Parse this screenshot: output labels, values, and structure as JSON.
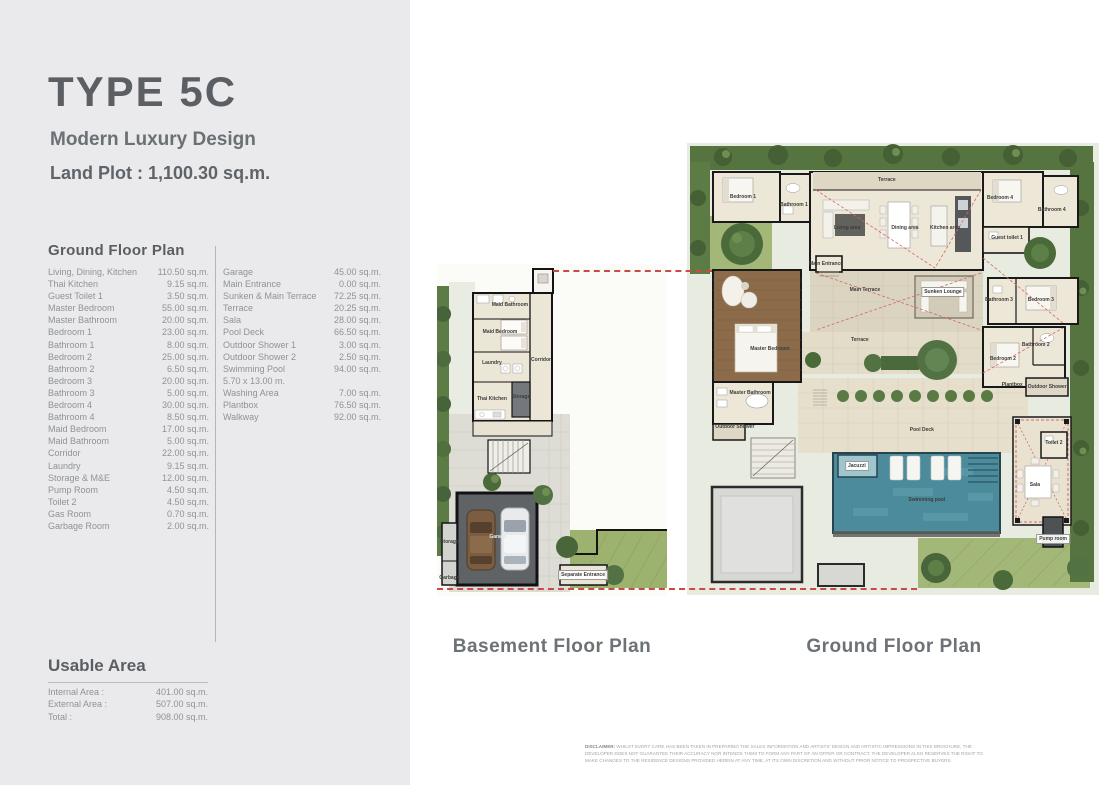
{
  "header": {
    "title": "TYPE 5C",
    "subtitle": "Modern Luxury Design",
    "land_plot": "Land Plot : 1,100.30 sq.m."
  },
  "area_table": {
    "heading": "Ground Floor Plan",
    "col1": [
      {
        "label": "Living, Dining, Kitchen",
        "value": "110.50 sq.m."
      },
      {
        "label": "Thai Kitchen",
        "value": "9.15 sq.m."
      },
      {
        "label": "Guest Toilet 1",
        "value": "3.50 sq.m."
      },
      {
        "label": "Master Bedroom",
        "value": "55.00 sq.m."
      },
      {
        "label": "Master Bathroom",
        "value": "20.00 sq.m."
      },
      {
        "label": "Bedroom 1",
        "value": "23.00 sq.m."
      },
      {
        "label": "Bathroom 1",
        "value": "8.00 sq.m."
      },
      {
        "label": "Bedroom 2",
        "value": "25.00 sq.m."
      },
      {
        "label": "Bathroom 2",
        "value": "6.50 sq.m."
      },
      {
        "label": "Bedroom 3",
        "value": "20.00 sq.m."
      },
      {
        "label": "Bathroom 3",
        "value": "5.00 sq.m."
      },
      {
        "label": "Bedroom 4",
        "value": "30.00 sq.m."
      },
      {
        "label": "Bathroom 4",
        "value": "8.50 sq.m."
      },
      {
        "label": "Maid Bedroom",
        "value": "17.00 sq.m."
      },
      {
        "label": "Maid Bathroom",
        "value": "5.00 sq.m."
      },
      {
        "label": "Corridor",
        "value": "22.00 sq.m."
      },
      {
        "label": "Laundry",
        "value": "9.15 sq.m."
      },
      {
        "label": "Storage & M&E",
        "value": "12.00 sq.m."
      },
      {
        "label": "Pump Room",
        "value": "4.50 sq.m."
      },
      {
        "label": "Toilet 2",
        "value": "4.50 sq.m."
      },
      {
        "label": "Gas Room",
        "value": "0.70 sq.m."
      },
      {
        "label": "Garbage Room",
        "value": "2.00 sq.m."
      }
    ],
    "col2": [
      {
        "label": "Garage",
        "value": "45.00 sq.m."
      },
      {
        "label": "Main Entrance",
        "value": "0.00 sq.m."
      },
      {
        "label": "Sunken & Main Terrace",
        "value": "72.25 sq.m."
      },
      {
        "label": "Terrace",
        "value": "20.25 sq.m."
      },
      {
        "label": "Sala",
        "value": "28.00 sq.m."
      },
      {
        "label": "Pool Deck",
        "value": "66.50 sq.m."
      },
      {
        "label": "Outdoor Shower 1",
        "value": "3.00 sq.m."
      },
      {
        "label": "Outdoor Shower 2",
        "value": "2.50 sq.m."
      },
      {
        "label": "Swimming Pool",
        "value": "94.00 sq.m."
      },
      {
        "label": "5.70 x 13.00 m.",
        "value": ""
      },
      {
        "label": "Washing Area",
        "value": "7.00 sq.m."
      },
      {
        "label": "Plantbox",
        "value": "76.50 sq.m."
      },
      {
        "label": "Walkway",
        "value": "92.00 sq.m."
      }
    ]
  },
  "usable_area": {
    "heading": "Usable Area",
    "rows": [
      {
        "label": "Internal Area :",
        "value": "401.00 sq.m."
      },
      {
        "label": "External Area :",
        "value": "507.00 sq.m."
      },
      {
        "label": "Total :",
        "value": "908.00 sq.m."
      }
    ]
  },
  "plans": {
    "basement": {
      "caption": "Basement Floor Plan",
      "labels": [
        {
          "text": "Maid Bathroom",
          "x": 31.7,
          "y": 12.3
        },
        {
          "text": "Maid Bedroom",
          "x": 27.4,
          "y": 20.5
        },
        {
          "text": "Laundry",
          "x": 23.9,
          "y": 29.8
        },
        {
          "text": "Corridor",
          "x": 45.2,
          "y": 28.9
        },
        {
          "text": "Thai Kitchen",
          "x": 23.9,
          "y": 40.7
        },
        {
          "text": "Storage",
          "x": 36.5,
          "y": 40.1
        },
        {
          "text": "Garage",
          "x": 26.5,
          "y": 82.2,
          "light": true
        },
        {
          "text": "Storage",
          "x": 5.4,
          "y": 83.7
        },
        {
          "text": "Garbage",
          "x": 5.4,
          "y": 94.6
        },
        {
          "text": "Separate Entrance",
          "x": 63.5,
          "y": 93.7,
          "chip": true
        }
      ]
    },
    "ground": {
      "caption": "Ground Floor Plan",
      "labels": [
        {
          "text": "Terrace",
          "x": 48.3,
          "y": 8.7
        },
        {
          "text": "Bedroom 1",
          "x": 14.2,
          "y": 12.2
        },
        {
          "text": "Bathroom 1",
          "x": 26.3,
          "y": 13.8
        },
        {
          "text": "Living area",
          "x": 38.9,
          "y": 18.6
        },
        {
          "text": "Dining area",
          "x": 52.6,
          "y": 18.6
        },
        {
          "text": "Kitchen area",
          "x": 62.1,
          "y": 18.6
        },
        {
          "text": "Bedroom 4",
          "x": 75.1,
          "y": 12.4
        },
        {
          "text": "Bathroom 4",
          "x": 87.4,
          "y": 14.9
        },
        {
          "text": "Guest toilet 1",
          "x": 76.8,
          "y": 20.7
        },
        {
          "text": "Main Entrance",
          "x": 33.9,
          "y": 26.0
        },
        {
          "text": "Main Terrace",
          "x": 43.1,
          "y": 31.4
        },
        {
          "text": "Sunken Lounge",
          "x": 61.6,
          "y": 31.8,
          "chip": true
        },
        {
          "text": "Bathroom 3",
          "x": 74.9,
          "y": 33.5
        },
        {
          "text": "Bedroom 3",
          "x": 84.8,
          "y": 33.5
        },
        {
          "text": "Bathroom 2",
          "x": 83.6,
          "y": 42.8
        },
        {
          "text": "Bedroom 2",
          "x": 75.8,
          "y": 45.7
        },
        {
          "text": "Master Bedroom",
          "x": 20.6,
          "y": 43.6
        },
        {
          "text": "Terrace",
          "x": 41.9,
          "y": 41.7
        },
        {
          "text": "Master Bathroom",
          "x": 15.9,
          "y": 52.7
        },
        {
          "text": "Outdoor Shower",
          "x": 12.3,
          "y": 59.7
        },
        {
          "text": "Plantbox",
          "x": 78.0,
          "y": 51.0
        },
        {
          "text": "Outdoor Shower",
          "x": 86.3,
          "y": 51.4
        },
        {
          "text": "Pool Deck",
          "x": 56.6,
          "y": 60.3
        },
        {
          "text": "Jacuzzi",
          "x": 41.2,
          "y": 67.8,
          "chip": true
        },
        {
          "text": "Swimming pool",
          "x": 57.8,
          "y": 74.8
        },
        {
          "text": "Sala",
          "x": 83.4,
          "y": 71.7
        },
        {
          "text": "Toilet 2",
          "x": 87.9,
          "y": 63.0
        },
        {
          "text": "Pump room",
          "x": 87.7,
          "y": 82.9,
          "chip": true
        }
      ]
    }
  },
  "disclaimer": {
    "label": "DISCLAIMER:",
    "text": " WHILST EVERY CARE HAS BEEN TAKEN IN PREPARING THE SALES INFORMATION AND ARTISTS' DESIGN AND ARTISTIC IMPRESSIONS IN THIS BROCHURE, THE DEVELOPER DOES NOT GUARANTEE THEIR ACCURACY NOR INTENDS THEM TO FORM ANY PART OF AN OFFER OR CONTRACT. THE DEVELOPER ALSO RESERVES THE RIGHT TO MAKE CHANGES TO THE RESIDENCE DESIGNS PROVIDED HEREIN AT ANY TIME, AT ITS OWN DISCRETION AND WITHOUT PRIOR NOTICE TO PROSPECTIVE BUYERS."
  }
}
